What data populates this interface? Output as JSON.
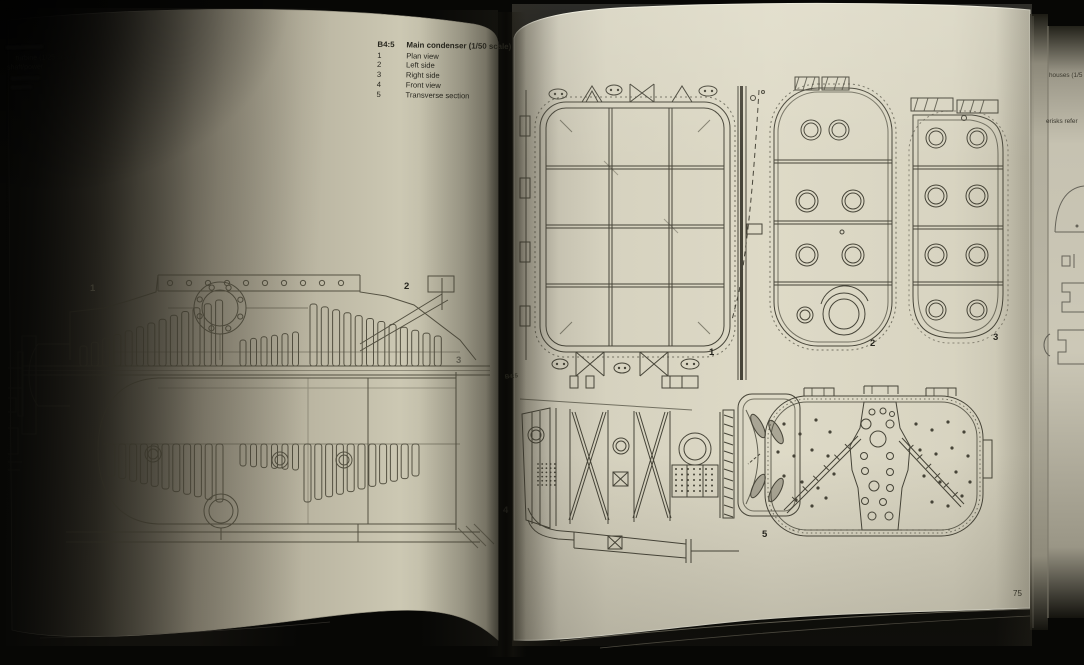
{
  "left_page": {
    "caption_fragments": [
      "turbine (1/25 scale)",
      "shaft/power"
    ],
    "figure_labels": {
      "a": "1",
      "b": "2",
      "c": "3"
    }
  },
  "right_page": {
    "caption": {
      "figure_no": "B4:5",
      "title": "Main condenser (1/50 scale)",
      "items": [
        {
          "no": "1",
          "label": "Plan view"
        },
        {
          "no": "2",
          "label": "Left side"
        },
        {
          "no": "3",
          "label": "Right side"
        },
        {
          "no": "4",
          "label": "Front view"
        },
        {
          "no": "5",
          "label": "Transverse section"
        }
      ]
    },
    "gutter_figure_no": "B4:5",
    "figure_labels": {
      "plan": "1",
      "left_side": "2",
      "right_side": "3",
      "front": "4",
      "transverse": "5"
    },
    "page_number": "75"
  },
  "fore_edge_fragments": [
    "houses (1/5",
    "erisks refer"
  ],
  "colors": {
    "paper": "#dcd8c3",
    "ink": "#3f3d32",
    "photo_background": "#070705"
  }
}
